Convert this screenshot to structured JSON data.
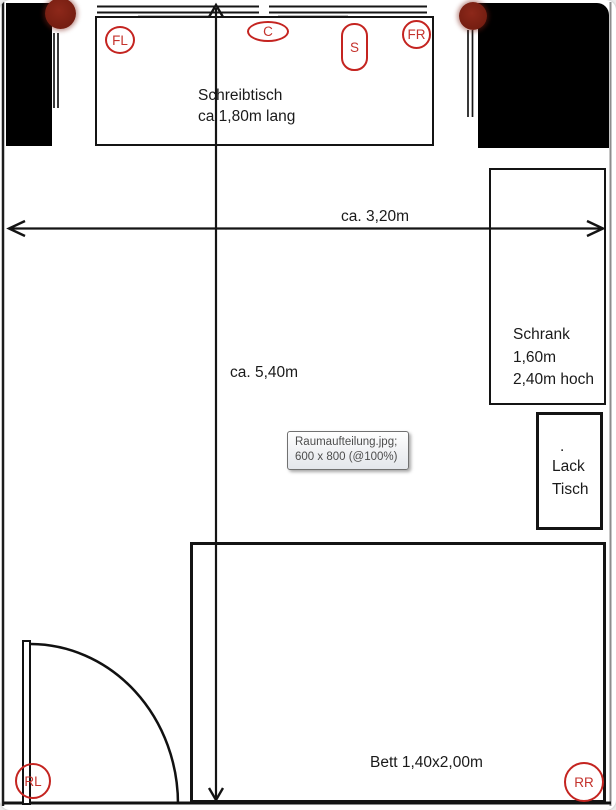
{
  "viewer": {
    "tooltip": {
      "filename_line": "Raumaufteilung.jpg;",
      "dimensions_line": "600 x 800 (@100%)"
    }
  },
  "room": {
    "desk": {
      "line1": "Schreibtisch",
      "line2": "ca 1,80m lang"
    },
    "wardrobe": {
      "line1": "Schrank",
      "line2": "1,60m",
      "line3": "2,40m hoch"
    },
    "lacquer_table": {
      "dot": ".",
      "line1": "Lack",
      "line2": "Tisch"
    },
    "bed": {
      "label": "Bett 1,40x2,00m"
    },
    "dimensions": {
      "width_label": "ca. 3,20m",
      "height_label": "ca. 5,40m"
    },
    "markers": {
      "front_left": "FL",
      "center": "C",
      "sub": "S",
      "front_right": "FR",
      "rear_left": "RL",
      "rear_right": "RR"
    }
  },
  "colors": {
    "line": "#1a1a1a",
    "annotation_red": "#c42420",
    "maroon_dot": "#7a2013",
    "tooltip_border": "#717171"
  }
}
